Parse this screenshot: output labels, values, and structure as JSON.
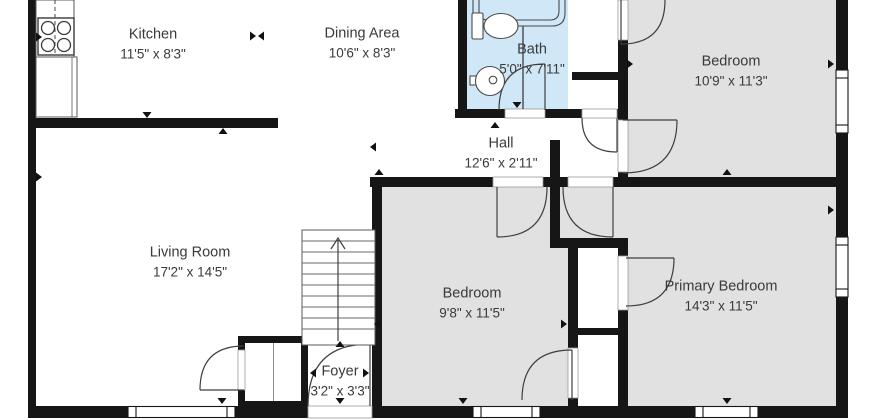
{
  "floor_plan": {
    "rooms": [
      {
        "id": "kitchen",
        "name": "Kitchen",
        "dimensions": "11'5\" x 8'3\""
      },
      {
        "id": "dining-area",
        "name": "Dining Area",
        "dimensions": "10'6\" x 8'3\""
      },
      {
        "id": "bath",
        "name": "Bath",
        "dimensions": "5'0\" x 7'11\""
      },
      {
        "id": "bedroom-top-right",
        "name": "Bedroom",
        "dimensions": "10'9\" x 11'3\""
      },
      {
        "id": "hall",
        "name": "Hall",
        "dimensions": "12'6\" x 2'11\""
      },
      {
        "id": "living-room",
        "name": "Living Room",
        "dimensions": "17'2\" x 14'5\""
      },
      {
        "id": "bedroom-middle",
        "name": "Bedroom",
        "dimensions": "9'8\" x 11'5\""
      },
      {
        "id": "primary-bedroom",
        "name": "Primary Bedroom",
        "dimensions": "14'3\" x 11'5\""
      },
      {
        "id": "foyer",
        "name": "Foyer",
        "dimensions": "3'2\" x 3'3\""
      }
    ],
    "fixtures": [
      "bathtub",
      "toilet",
      "sink",
      "stove",
      "kitchen-counter",
      "staircase",
      "closets",
      "windows",
      "doors"
    ],
    "colors": {
      "walls": "#161616",
      "bedroom_fill": "#e1e1e1",
      "bath_fill": "#cfe7f6",
      "floor_fill": "#ffffff",
      "label_text": "#3a3a3a",
      "fixture_stroke": "#4a4a4a"
    }
  }
}
